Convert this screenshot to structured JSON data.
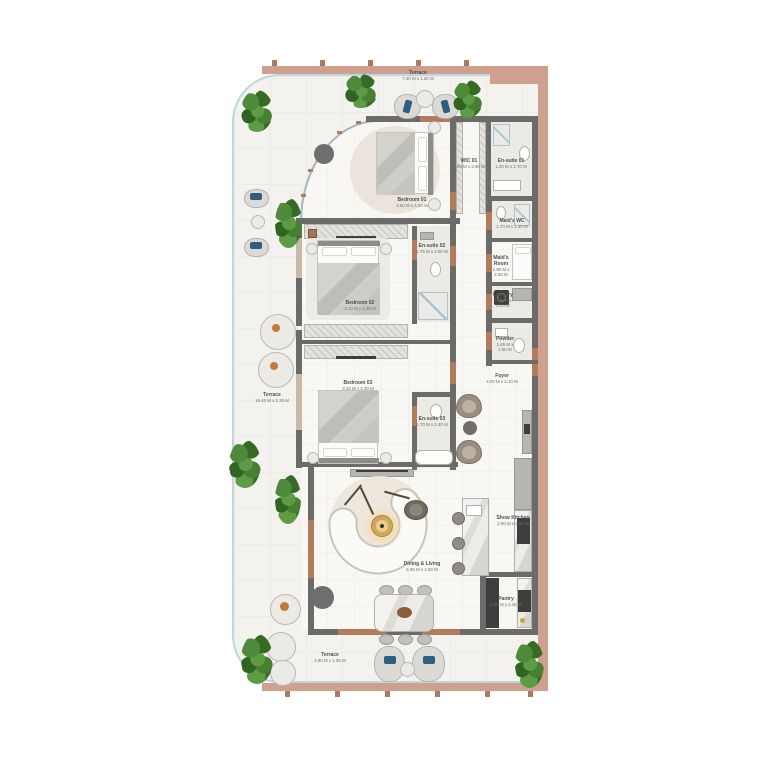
{
  "rooms": {
    "terrace_top": {
      "name": "Terrace",
      "dims": "7.40 M x 1.60 M"
    },
    "bedroom_01": {
      "name": "Bedroom 01",
      "dims": "4.60 M x 4.20 M"
    },
    "wic_01": {
      "name": "WIC 01",
      "dims": "1.90 M x 2.90 M"
    },
    "ensuite_01": {
      "name": "En-suite 01",
      "dims": "1.20 M x 2.70 M"
    },
    "maids_wc": {
      "name": "Maid's WC",
      "dims": "1.70 M x 1.20 M"
    },
    "maids_room": {
      "name": "Maid's Room",
      "dims": "1.90 M x 2.00 M"
    },
    "laundry": {
      "name": "Laundry",
      "dims": "1.40 M x 2.00 M"
    },
    "powder": {
      "name": "Powder",
      "dims": "1.65 M x 1.50 M"
    },
    "foyer": {
      "name": "Foyer",
      "dims": "4.00 M x 2.10 M"
    },
    "bedroom_02": {
      "name": "Bedroom 02",
      "dims": "3.10 M x 4.30 M"
    },
    "ensuite_02": {
      "name": "En-suite 02",
      "dims": "1.75 M x 2.60 M"
    },
    "terrace_left": {
      "name": "Terrace",
      "dims": "16.40 M x 2.30 M"
    },
    "bedroom_03": {
      "name": "Bedroom 03",
      "dims": "3.10 M x 4.30 M"
    },
    "ensuite_03": {
      "name": "En-suite 03",
      "dims": "1.70 M x 2.40 M"
    },
    "dining_living": {
      "name": "Dining & Living",
      "dims": "5.95 M x 4.50 M"
    },
    "show_kitchen": {
      "name": "Show Kitchen",
      "dims": "2.90 M x 3.95 M"
    },
    "pantry": {
      "name": "Pantry",
      "dims": "2.10 M x 2.00 M"
    },
    "terrace_bottom": {
      "name": "Terrace",
      "dims": "4.90 M x 1.50 M"
    }
  },
  "colors": {
    "facade_band": "#cfa08e",
    "walls": "#6b6b69",
    "terrace_floor": "#f3f2ee",
    "interior_floor": "#f8f7f4",
    "glass_railing": "#b9d7e5",
    "door_threshold": "#b27b5d",
    "plant_green": "#4e8a3a",
    "cushion_blue": "#2f5f80",
    "cushion_orange": "#c27a36"
  }
}
